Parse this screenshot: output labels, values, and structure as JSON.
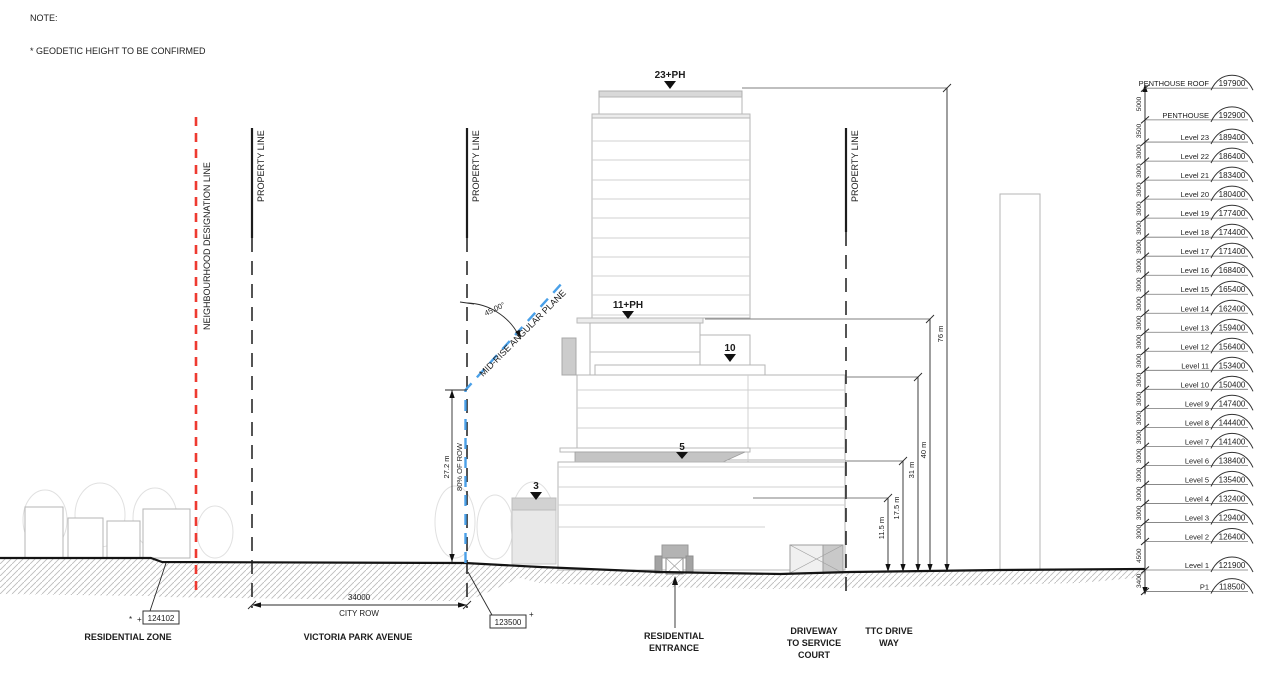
{
  "note": {
    "heading": "NOTE:",
    "item": "*  GEODETIC HEIGHT TO BE CONFIRMED"
  },
  "lines": {
    "neighbourhood_designation": "NEIGHBOURHOOD DESIGNATION LINE",
    "property_line_left": "PROPERTY LINE",
    "property_line_mid": "PROPERTY LINE",
    "property_line_right": "PROPERTY LINE",
    "angular_plane": "MID-RISE ANGULAR PLANE",
    "angular_plane_angle": "45.00°"
  },
  "building_markers": {
    "tower": "23+PH",
    "midrise": "11+PH",
    "level10": "10",
    "level5": "5",
    "level3": "3"
  },
  "dims": {
    "row_height": "27.2 m",
    "row_share": "80% OF ROW",
    "city_row_value": "34000",
    "city_row_name": "CITY ROW",
    "h76": "76 m",
    "h40": "40 m",
    "h31": "31 m",
    "h17": "17.5 m",
    "h11": "11.5 m"
  },
  "spot_elevations": {
    "star": "*",
    "plus_left": "+",
    "left": "124102",
    "right": "123500",
    "plus_right": "+"
  },
  "street_labels": {
    "residential_zone": "RESIDENTIAL ZONE",
    "avenue": "VICTORIA PARK AVENUE",
    "entrance": [
      "RESIDENTIAL",
      "ENTRANCE"
    ],
    "driveway": [
      "DRIVEWAY",
      "TO SERVICE",
      "COURT"
    ],
    "ttc": [
      "TTC DRIVE",
      "WAY"
    ]
  },
  "levels": [
    {
      "name": "PENTHOUSE ROOF",
      "elev": "197900",
      "mm": 197900
    },
    {
      "name": "PENTHOUSE",
      "elev": "192900",
      "mm": 192900
    },
    {
      "name": "Level 23",
      "elev": "189400",
      "mm": 189400
    },
    {
      "name": "Level 22",
      "elev": "186400",
      "mm": 186400
    },
    {
      "name": "Level 21",
      "elev": "183400",
      "mm": 183400
    },
    {
      "name": "Level 20",
      "elev": "180400",
      "mm": 180400
    },
    {
      "name": "Level 19",
      "elev": "177400",
      "mm": 177400
    },
    {
      "name": "Level 18",
      "elev": "174400",
      "mm": 174400
    },
    {
      "name": "Level 17",
      "elev": "171400",
      "mm": 171400
    },
    {
      "name": "Level 16",
      "elev": "168400",
      "mm": 168400
    },
    {
      "name": "Level 15",
      "elev": "165400",
      "mm": 165400
    },
    {
      "name": "Level 14",
      "elev": "162400",
      "mm": 162400
    },
    {
      "name": "Level 13",
      "elev": "159400",
      "mm": 159400
    },
    {
      "name": "Level 12",
      "elev": "156400",
      "mm": 156400
    },
    {
      "name": "Level 11",
      "elev": "153400",
      "mm": 153400
    },
    {
      "name": "Level 10",
      "elev": "150400",
      "mm": 150400
    },
    {
      "name": "Level 9",
      "elev": "147400",
      "mm": 147400
    },
    {
      "name": "Level 8",
      "elev": "144400",
      "mm": 144400
    },
    {
      "name": "Level 7",
      "elev": "141400",
      "mm": 141400
    },
    {
      "name": "Level 6",
      "elev": "138400",
      "mm": 138400
    },
    {
      "name": "Level 5",
      "elev": "135400",
      "mm": 135400
    },
    {
      "name": "Level 4",
      "elev": "132400",
      "mm": 132400
    },
    {
      "name": "Level 3",
      "elev": "129400",
      "mm": 129400
    },
    {
      "name": "Level 2",
      "elev": "126400",
      "mm": 126400
    },
    {
      "name": "Level 1",
      "elev": "121900",
      "mm": 121900
    },
    {
      "name": "P1",
      "elev": "118500",
      "mm": 118500
    }
  ],
  "level_spacings": [
    "5000",
    "3500",
    "3000",
    "3000",
    "3000",
    "3000",
    "3000",
    "3000",
    "3000",
    "3000",
    "3000",
    "3000",
    "3000",
    "3000",
    "3000",
    "3000",
    "3000",
    "3000",
    "3000",
    "3000",
    "3000",
    "3000",
    "3000",
    "4500",
    "3400"
  ],
  "colors": {
    "designation_red": "#ee3a31",
    "angular_blue": "#4aa0e8",
    "drawing_black": "#1c1c1c"
  }
}
